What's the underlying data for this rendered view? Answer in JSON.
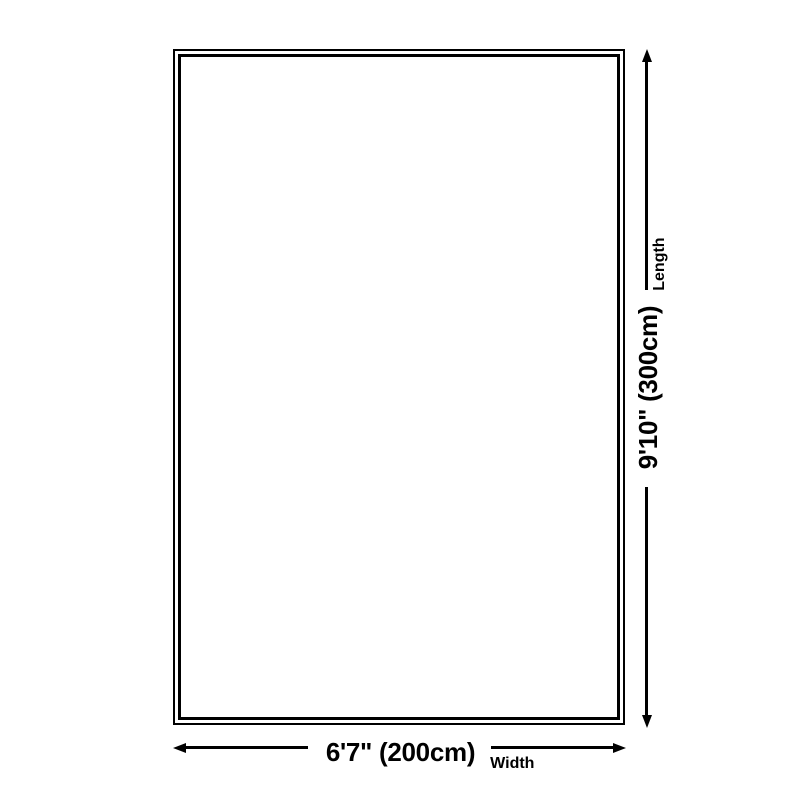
{
  "canvas": {
    "background": "#ffffff",
    "line_color": "#000000"
  },
  "rug": {
    "outline": "double-border rectangle"
  },
  "dimensions": {
    "width": {
      "text": "6'7\" (200cm)",
      "label": "Width",
      "cm": 200
    },
    "length": {
      "text": "9'10\" (300cm)",
      "label": "Length",
      "cm": 300
    }
  },
  "icons": {
    "arrow_left": "solid triangle pointing left",
    "arrow_right": "solid triangle pointing right",
    "arrow_up": "solid triangle pointing up",
    "arrow_down": "solid triangle pointing down"
  }
}
